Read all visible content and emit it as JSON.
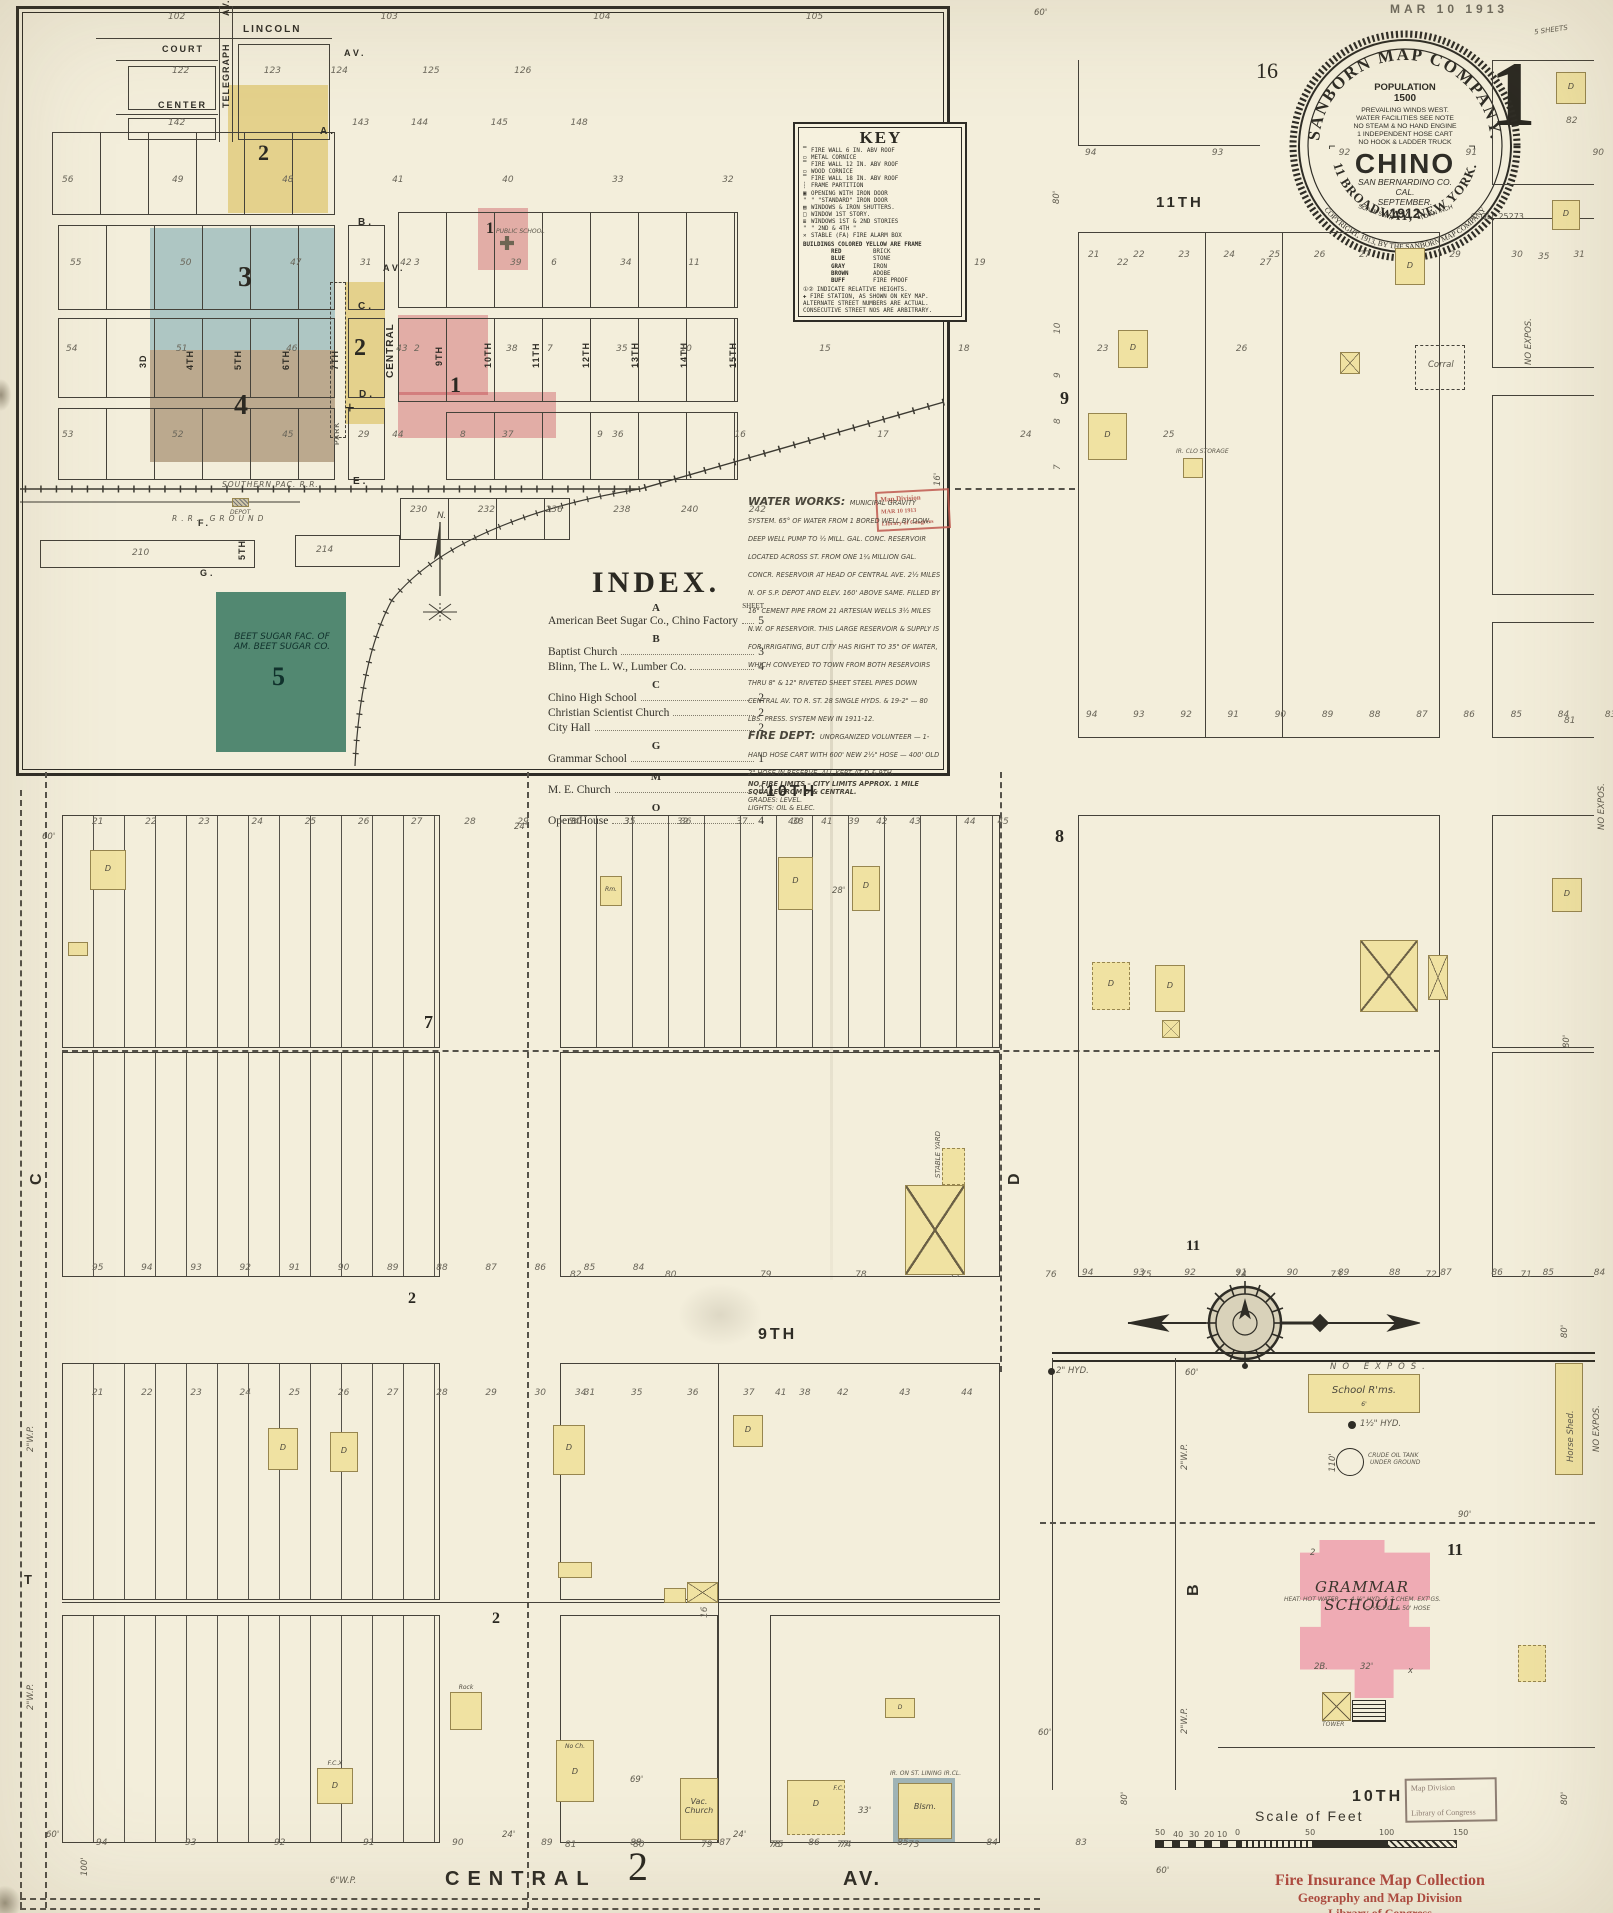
{
  "sheet": {
    "date_stamp": "MAR 10 1913",
    "page_ref_left": "16",
    "sheet_number": "1",
    "sheets_note": "5 SHEETS",
    "copyright_code": "© QLF 25273"
  },
  "seal": {
    "ring_top": "SANBORN MAP COMPANY.",
    "ring_bottom": "11 BROADWAY, NEW YORK.",
    "ring_outer_bottom": "COPYRIGHT, 1913, BY THE SANBORN MAP COMPANY",
    "population_label": "POPULATION",
    "population_value": "1500",
    "facts": [
      "PREVAILING WINDS WEST.",
      "WATER FACILITIES SEE NOTE",
      "NO STEAM & NO HAND ENGINE",
      "1 INDEPENDENT HOSE CART",
      "NO HOOK & LADDER TRUCK"
    ],
    "city": "CHINO",
    "county": "SAN BERNARDINO CO.",
    "state": "CAL.",
    "month": "SEPTEMBER.",
    "scale_left": "SCALE 50FT.",
    "year": "1912",
    "scale_right": "TO AN INCH"
  },
  "key": {
    "title": "KEY",
    "items": [
      "FIRE WALL 6 IN. ABV ROOF",
      "METAL CORNICE",
      "FIRE WALL 12 IN. ABV ROOF",
      "WOOD CORNICE",
      "FIRE WALL 18 IN. ABV ROOF",
      "FRAME PARTITION",
      "OPENING WITH IRON DOOR",
      "\"  \"STANDARD\" IRON DOOR",
      "WINDOWS & IRON SHUTTERS.",
      "WINDOW 1ST STORY.",
      "WINDOWS 1ST & 2ND STORIES",
      "\"   2ND & 4TH   \"",
      "STABLE  (FA) FIRE ALARM BOX"
    ],
    "color_note": "BUILDINGS COLORED YELLOW ARE FRAME",
    "color_rows": [
      [
        "RED",
        "BRICK"
      ],
      [
        "BLUE",
        "STONE"
      ],
      [
        "GRAY",
        "IRON"
      ],
      [
        "BROWN",
        "ADOBE"
      ],
      [
        "BUFF",
        "FIRE PROOF"
      ]
    ],
    "footnotes": [
      "①② INDICATE RELATIVE HEIGHTS.",
      "✚ FIRE STATION, AS SHOWN ON KEY MAP.",
      "ALTERNATE STREET NUMBERS ARE ACTUAL.",
      "CONSECUTIVE STREET NOS ARE ARBITRARY."
    ]
  },
  "index": {
    "title": "INDEX.",
    "sheet_label": "SHEET",
    "groups": [
      {
        "letter": "A",
        "entries": [
          {
            "name": "American Beet Sugar Co., Chino Factory",
            "sheet": "5"
          }
        ]
      },
      {
        "letter": "B",
        "entries": [
          {
            "name": "Baptist Church",
            "sheet": "3"
          },
          {
            "name": "Blinn, The L. W., Lumber Co.",
            "sheet": "4"
          }
        ]
      },
      {
        "letter": "C",
        "entries": [
          {
            "name": "Chino High School",
            "sheet": "2"
          },
          {
            "name": "Christian Scientist Church",
            "sheet": "2"
          },
          {
            "name": "City Hall",
            "sheet": "2"
          }
        ]
      },
      {
        "letter": "G",
        "entries": [
          {
            "name": "Grammar School",
            "sheet": "1"
          }
        ]
      },
      {
        "letter": "M",
        "entries": [
          {
            "name": "M. E. Church",
            "sheet": "2"
          }
        ]
      },
      {
        "letter": "O",
        "entries": [
          {
            "name": "Opera House",
            "sheet": "4"
          }
        ]
      }
    ]
  },
  "notes": {
    "water_works_title": "WATER WORKS:",
    "water_works": "MUNICIPAL GRAVITY SYSTEM. 65° OF WATER FROM 1 BORED WELL BY DOW. DEEP WELL PUMP TO ½ MILL. GAL. CONC. RESERVOIR LOCATED ACROSS ST. FROM ONE 1¼ MILLION GAL. CONCR. RESERVOIR AT HEAD OF CENTRAL AVE. 2½ MILES N. OF S.P. DEPOT AND ELEV. 160' ABOVE SAME. FILLED BY 16\" CEMENT PIPE FROM 21 ARTESIAN WELLS 3½ MILES N.W. OF RESERVOIR. THIS LARGE RESERVOIR & SUPPLY IS FOR IRRIGATING, BUT CITY HAS RIGHT TO 35\" OF WATER, WHICH CONVEYED TO TOWN FROM BOTH RESERVOIRS THRU 8\" & 12\" RIVETED SHEET STEEL PIPES DOWN CENTRAL AV. TO R. ST. 28 SINGLE HYDS. & 19-2\" — 80 LBS. PRESS. SYSTEM NEW IN 1911-12.",
    "fire_dept_title": "FIRE DEPT:",
    "fire_dept": "UNORGANIZED VOLUNTEER — 1-HAND HOSE CART WITH 600' NEW 2½\" HOSE — 400' OLD 2\" HOSE IN RESERVE. ALL KEPT AT D & 9TH.",
    "no_fire_limits": "NO FIRE LIMITS – CITY LIMITS APPROX. 1 MILE SQUARE FROM D & CENTRAL.",
    "grades": "GRADES: LEVEL.",
    "lights": "LIGHTS: OIL & ELEC."
  },
  "stamps": {
    "division_line1": "Map Division",
    "division_line2": "MAR 10 1913",
    "division_line3": "Library of Congress",
    "collection_line1": "Fire Insurance Map Collection",
    "collection_line2": "Geography and Map Division",
    "collection_line3": "Library of Congress"
  },
  "inset": {
    "streets": {
      "lincoln": "LINCOLN",
      "lincoln_av": "AV.",
      "court": "COURT",
      "center": "CENTER",
      "telegraph": "TELEGRAPH",
      "telegraph_av": "AV.",
      "a": "A.",
      "b": "B.",
      "c": "C.",
      "d": "D.",
      "e": "E.",
      "f": "F.",
      "g": "G.",
      "central": "CENTRAL",
      "central_av": "AV.",
      "park": "PARK",
      "third": "3D",
      "fourth": "4TH",
      "fifth": "5TH",
      "sixth": "6TH",
      "seventh": "7TH",
      "ninth": "9TH",
      "tenth": "10TH",
      "eleventh": "11TH",
      "twelfth": "12TH",
      "thirteenth": "13TH",
      "fourteenth": "14TH",
      "fifteenth": "15TH",
      "fifth_south": "5TH"
    },
    "railroad": {
      "main": "SOUTHERN PAC. R.R.",
      "depot": "DEPOT",
      "ground": "R.R. GROUND"
    },
    "north": "N.",
    "block_numbers": {
      "b2a": "2",
      "b3": "3",
      "b4": "4",
      "b2b": "2",
      "b1a": "1",
      "b1b": "1",
      "b5": "5",
      "cross": "+"
    },
    "public_school": "PUBLIC SCHOOL",
    "beet_sugar_line1": "BEET SUGAR FAC. OF",
    "beet_sugar_line2": "AM. BEET SUGAR CO.",
    "lot_rows": {
      "r0": "102    103    104    105",
      "r1": "122   123  124   125   126",
      "r2": "142        143  144   145   148",
      "r3": "56   49   48   41   40   33   32",
      "r4": "55   50   47   42   39   34",
      "r5": "54   51   46   43   38   35",
      "r6": "53   52   45   44   37   36",
      "r7": "31",
      "r8": "3    6    11    14    19    22    27",
      "r9": "2    7    10    15    18    23    26",
      "r10": "8    9    16    17    24    25",
      "r11": "29",
      "r12": "230   232   236   238   240   242",
      "r13": "210",
      "r14": "214"
    }
  },
  "main": {
    "streets": {
      "eleventh": "11TH",
      "tenth_left": "10TH",
      "ninth_left": "9TH",
      "tenth_br": "10TH",
      "central": "CENTRAL",
      "central_av": "AV.",
      "d": "D",
      "c": "C",
      "b": "B",
      "t": "T"
    },
    "sheet_refs": {
      "n9": "9",
      "n8": "8",
      "n7": "7",
      "n2a": "2",
      "n2b": "2",
      "n2c": "2",
      "n11a": "11",
      "n11b": "11",
      "n16": "16"
    },
    "lot_rows": {
      "m1": "94    93    92    91    90",
      "m2": "21  22  23  24  25  26  27  28  29   30   31   32   33",
      "m3": "94  93  92  91  90  89  88  87  86  85  84  83",
      "m4": "21  22  23  24  25  26  27  28  29  30  31  32",
      "m5": "34   35   36   37   38   39",
      "m5b": "40  41    42  43    44  45",
      "m6": "95  94  93  92  91  90  89  88  87  86  85  84",
      "m7": "82   80   79   78   77   76   75   74   73   72   71",
      "m8": "94  93  92  91  90  89  88  87  86  85  84  83",
      "m9": "21  22  23  24  25  26  27  28  29  30  31",
      "m10": "34   35   36   37   38",
      "m10b": "41   42   43   44",
      "m11": "94   93   92   91   90   89   88   87   86   85   84   83",
      "m12": "81   80   79   78   77",
      "m13": "75   74   73",
      "v9_10": "10",
      "v9_9": "9",
      "v9_8": "8",
      "v9_7": "7",
      "r35": "35",
      "r81": "81",
      "r82": "82"
    },
    "buildings": {
      "d": "D",
      "fc": "F.C.",
      "fcx": "F.C.X",
      "rm": "Rm.",
      "ir_clo": "IR. CLO STORAGE",
      "corral": "Corral",
      "stable_yard": "STABLE YARD",
      "school_rms": "School R'ms.",
      "horse_shed": "Horse Shed.",
      "no_ch": "No Ch.",
      "vac_church": "Vac.\nChurch",
      "rock": "Rock",
      "blsm": "Blsm.",
      "ir_lining": "IR. ON ST. LINING  IR.CL.",
      "grammar_school": "GRAMMAR SCHOOL",
      "grammar_note": "HEAT: HOT WATER. — 4-½\" HYD. & 7 CHEM. EXT'GS.",
      "grammar_hose": "○ ½\" P.O. & 50' HOSE",
      "tower": "TOWER",
      "crude_oil1": "CRUDE OIL TANK",
      "crude_oil2": "UNDER GROUND",
      "no_expos": "NO EXPOS.",
      "hyd15": "1½\" HYD.",
      "hyd2": "2\" HYD."
    },
    "measures": {
      "ft60": "60'",
      "ft80": "80'",
      "ft100": "100'",
      "ft110": "110'",
      "ft90": "90'",
      "ft24": "24'",
      "ft16": "16'",
      "ft69": "69'",
      "ft33": "33'",
      "ft32": "32'",
      "ft6": "6'",
      "ft28": "28'",
      "wp2": "2\"W.P.",
      "wp6": "6\"W.P.",
      "n2b_lot": "2B.",
      "sm2": "2",
      "x": "x"
    }
  },
  "scale_bar": {
    "title": "Scale of Feet",
    "ticks": [
      "50",
      "40",
      "30",
      "20",
      "10",
      "0",
      "50",
      "100",
      "150"
    ]
  }
}
